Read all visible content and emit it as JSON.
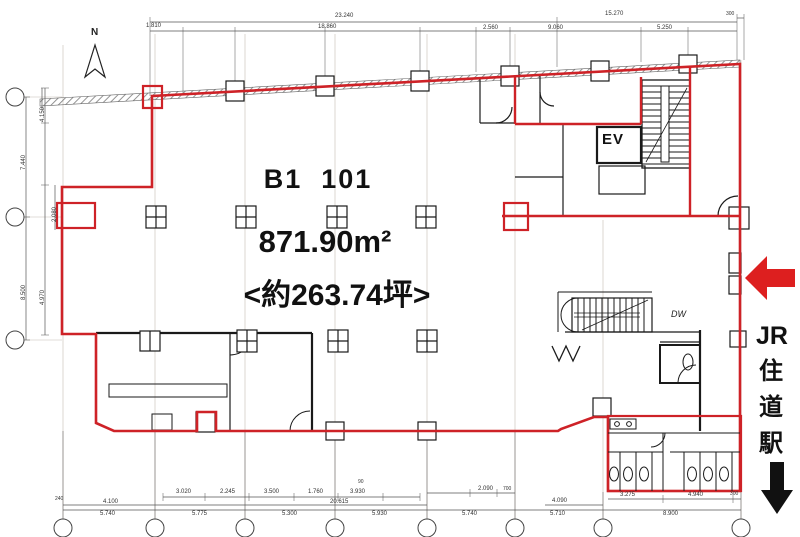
{
  "drawing": {
    "unit_label": "B1  101",
    "area_m2": "871.90m²",
    "area_tsubo": "<約263.74坪>",
    "north_label": "N",
    "elevator_label": "EV",
    "dumbwaiter_label": "DW"
  },
  "station": {
    "prefix": "JR",
    "chars": [
      "住",
      "道",
      "駅"
    ]
  },
  "colors": {
    "lease_boundary_red": "#ce2227",
    "arrow_red": "#dd1f1f",
    "ink_black": "#1a1a1a",
    "hatch_gray": "#888888"
  },
  "dimensions": {
    "top_row1": [
      "23.240",
      "15.270",
      "300"
    ],
    "top_row2": [
      "1.810",
      "18.860",
      "2.560",
      "9.060",
      "5.250"
    ],
    "left_col": [
      "7.440",
      "4.150",
      "4.970",
      "8.500",
      "2.080"
    ],
    "bottom_small_left": [
      "3.020",
      "2.245",
      "3.500",
      "1.760",
      "3.930"
    ],
    "bottom_small_right": [
      "2.090",
      "700",
      "4.090",
      "3.275",
      "4.940",
      "300"
    ],
    "bottom_main": [
      "5.740",
      "5.775",
      "5.300",
      "5.930",
      "5.740",
      "5.710",
      "8.900"
    ],
    "misc": [
      "90",
      "20.615",
      "4.100",
      "240"
    ]
  }
}
